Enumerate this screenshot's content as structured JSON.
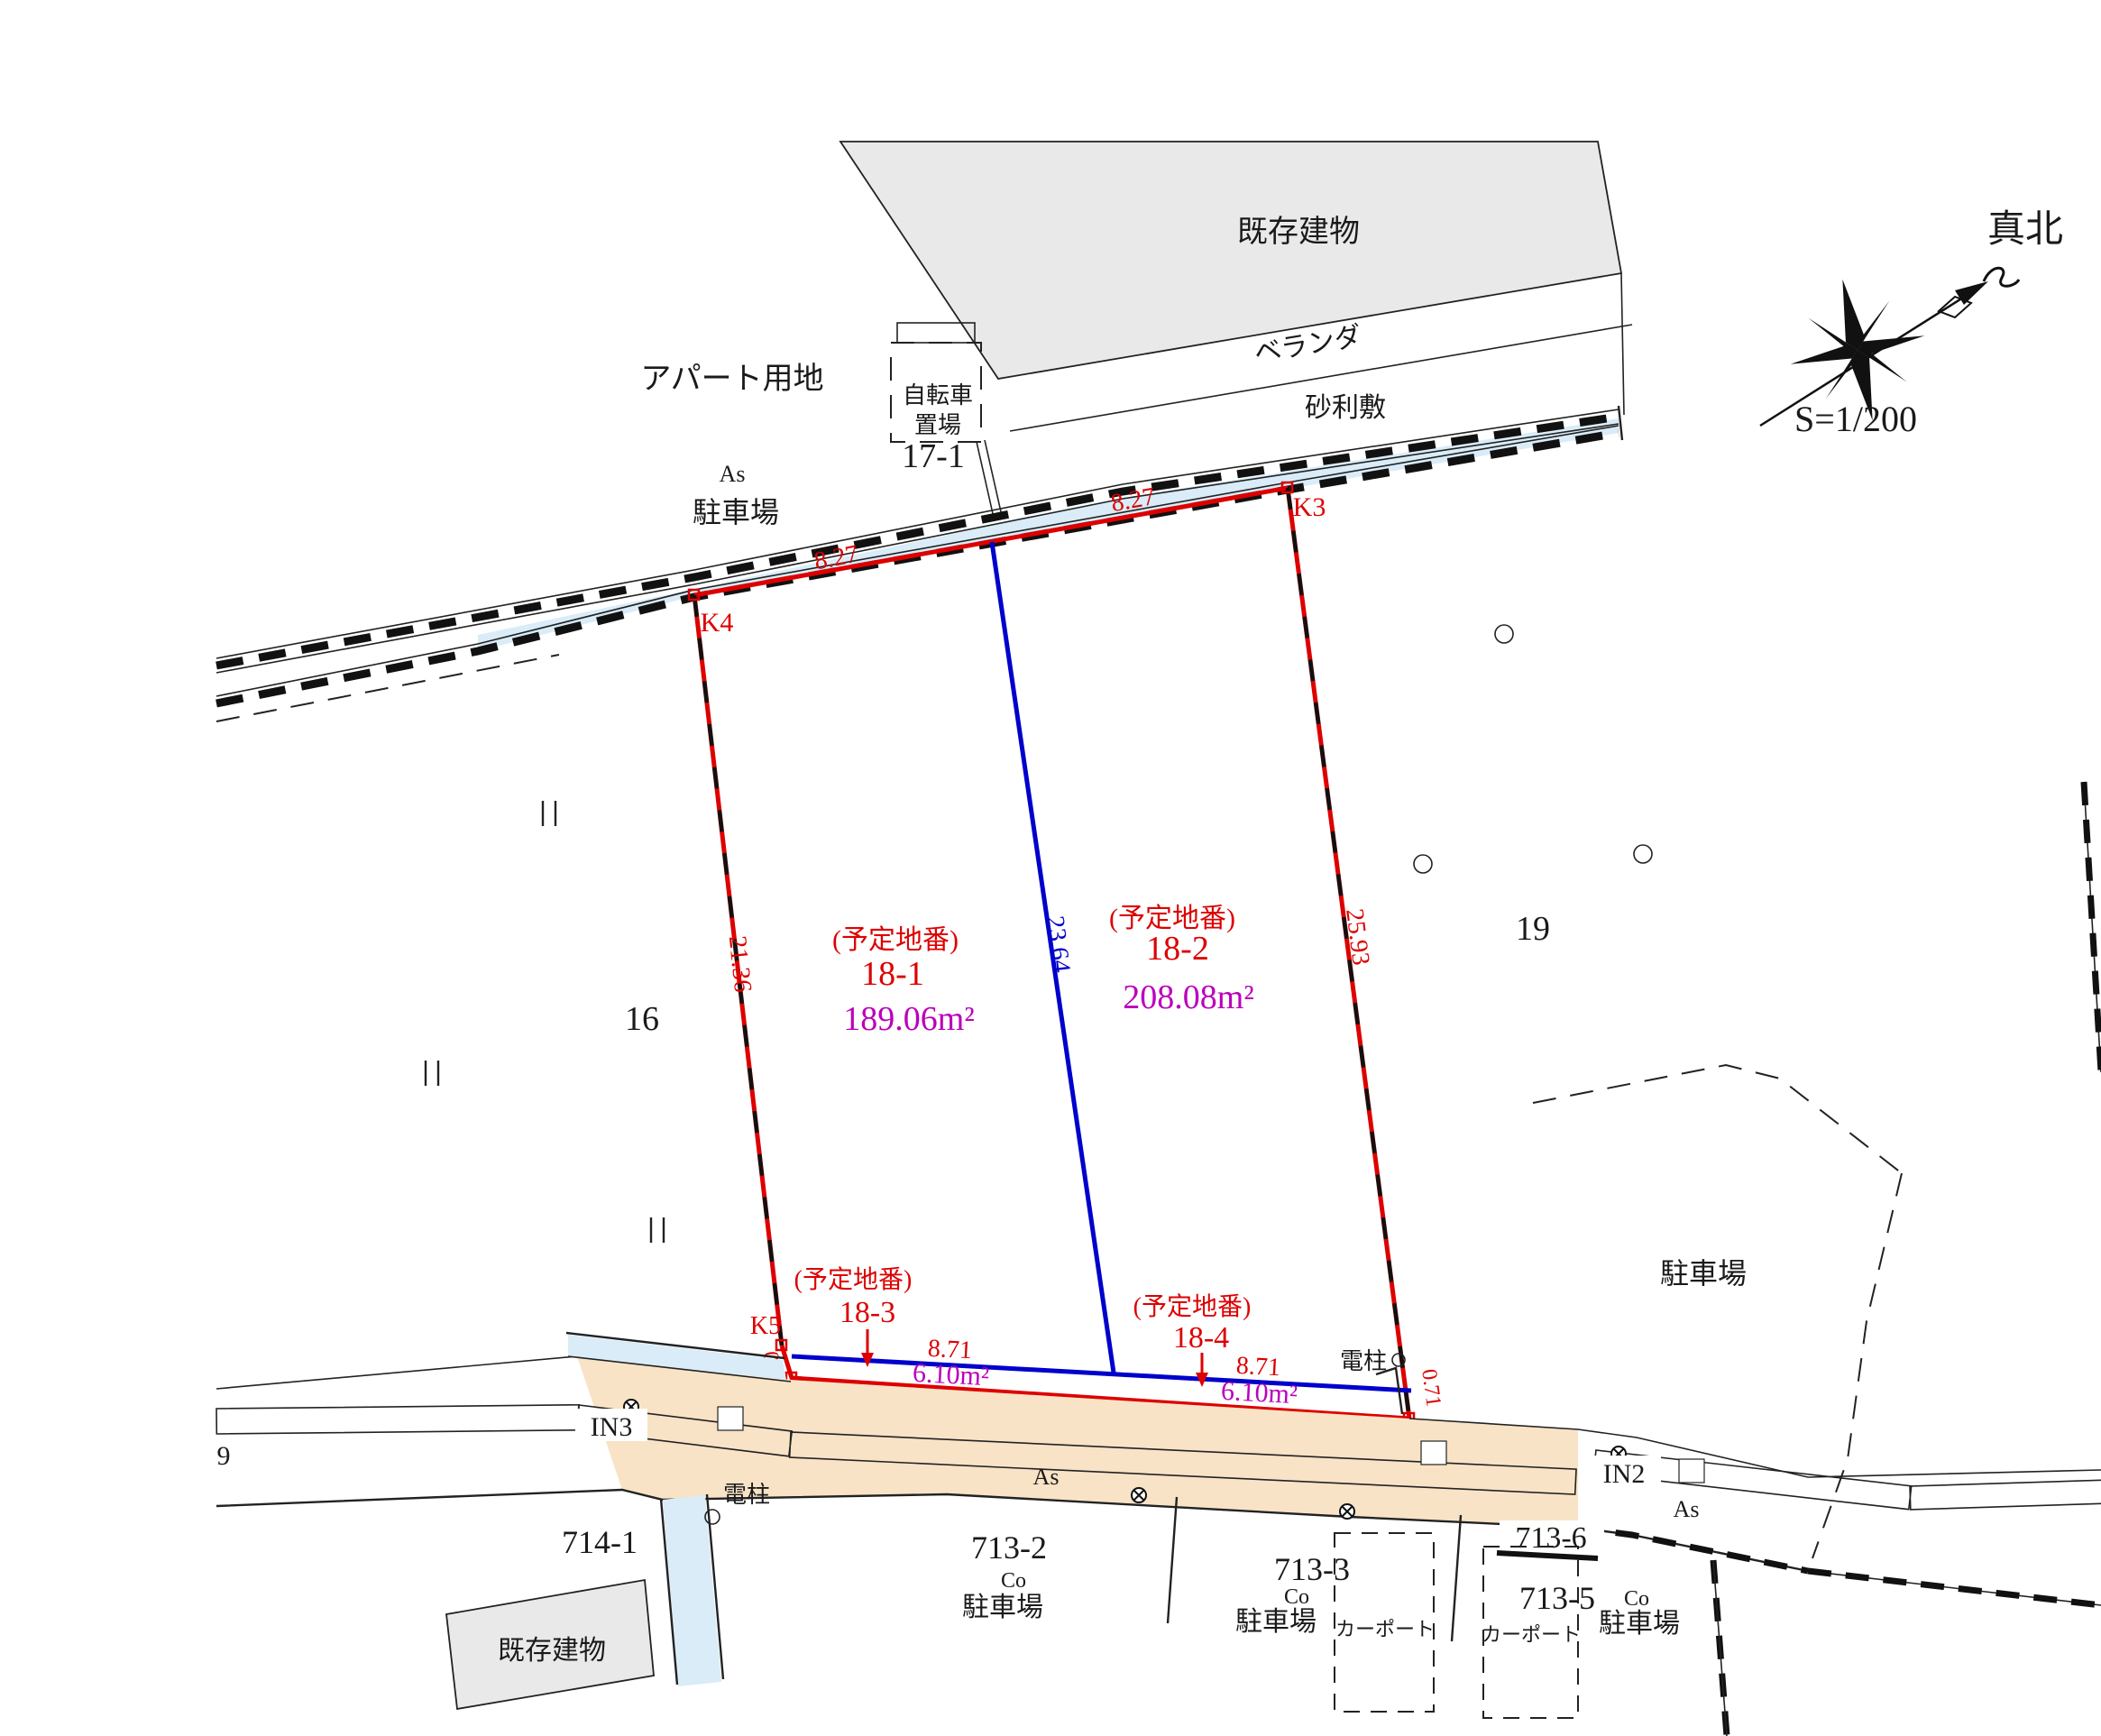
{
  "colors": {
    "red": "#dd0000",
    "blue": "#0000cc",
    "magenta": "#bb00bb",
    "water": "#d9ecf8",
    "road": "#f8e3c6",
    "building": "#e9e9e9"
  },
  "compass": {
    "north": "真北",
    "scale": "S=1/200"
  },
  "words": {
    "existing_building": "既存建物",
    "veranda": "ベランダ",
    "gravel": "砂利敷",
    "apartment_site": "アパート用地",
    "bicycle_line1": "自転車",
    "bicycle_line2": "置場",
    "parking": "駐車場",
    "as": "As",
    "co": "Co",
    "carport": "カーポート",
    "pole": "電柱"
  },
  "plots": {
    "p18_1": {
      "caption": "(予定地番)",
      "number": "18-1",
      "area": "189.06m²"
    },
    "p18_2": {
      "caption": "(予定地番)",
      "number": "18-2",
      "area": "208.08m²"
    },
    "p18_3": {
      "caption": "(予定地番)",
      "number": "18-3",
      "area": "6.10m²",
      "frontage": "8.71"
    },
    "p18_4": {
      "caption": "(予定地番)",
      "number": "18-4",
      "area": "6.10m²",
      "frontage": "8.71"
    }
  },
  "dimensions": {
    "top_left": "8.27",
    "top_right": "8.27",
    "west": "21.36",
    "center": "23.64",
    "east": "25.93",
    "k5_offset": "0.73",
    "k2_offset": "0.71"
  },
  "points": {
    "k1": "K1",
    "k2": "K2",
    "k3": "K3",
    "k4": "K4",
    "k5": "K5",
    "in2": "IN2",
    "in3": "IN3"
  },
  "parcels": {
    "n17_1": "17-1",
    "n16": "16",
    "n19": "19",
    "n9": "9",
    "n714_1": "714-1",
    "n713_2": "713-2",
    "n713_3": "713-3",
    "n713_5": "713-5",
    "n713_6": "713-6"
  }
}
